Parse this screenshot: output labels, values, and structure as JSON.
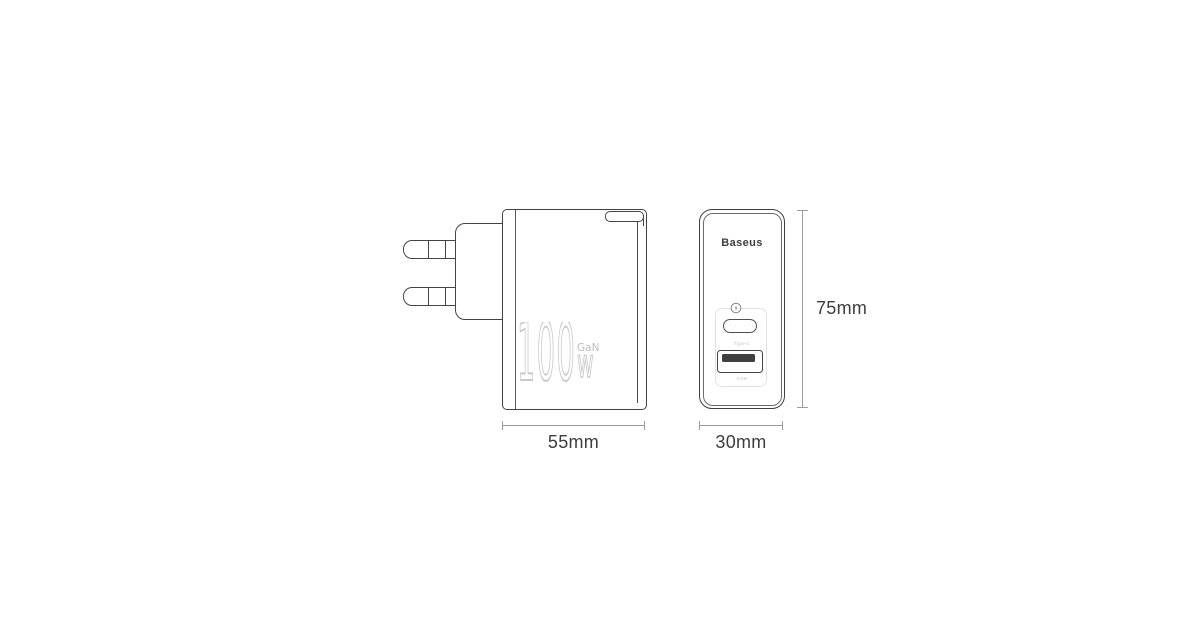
{
  "colors": {
    "background": "#ffffff",
    "outline_dark": "#424242",
    "outline_faint": "#e2e2e2",
    "watermark_stroke": "#c9c9c9",
    "dimension_line": "#9c9c9c",
    "dimension_text": "#3d3d3d",
    "port_pin_fill": "#3f3f3f",
    "port_label_text": "#c6c6c6"
  },
  "side_view": {
    "watermark": {
      "number": "100",
      "unit": "w",
      "tech": "GaN"
    },
    "width_dimension": "55mm"
  },
  "front_view": {
    "brand": "Baseus",
    "icons": {
      "above_usbc": "quick-charge-lightning-circle-icon"
    },
    "ports": {
      "usb_c_label": "Type-C",
      "usb_a_label": "USB"
    },
    "width_dimension": "30mm",
    "height_dimension": "75mm"
  }
}
